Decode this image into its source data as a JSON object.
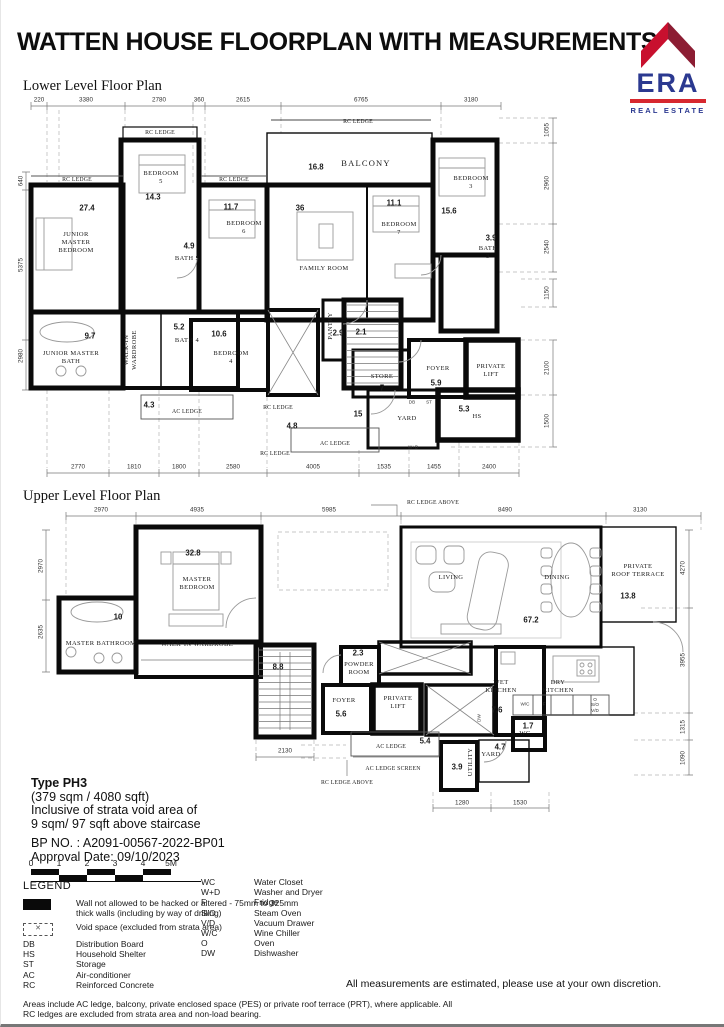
{
  "header": {
    "title": "WATTEN HOUSE FLOORPLAN WITH MEASUREMENTS",
    "logo": {
      "name": "ERA",
      "tagline": "REAL ESTATE",
      "colors": {
        "roof_left": "#C8102E",
        "roof_right": "#8C1D33",
        "text": "#2B3990",
        "bar": "#D7282F"
      }
    }
  },
  "lower_plan": {
    "heading": "Lower Level Floor Plan",
    "labels": [
      {
        "t": "220",
        "x": 38,
        "y": 100,
        "c": "dim"
      },
      {
        "t": "3380",
        "x": 85,
        "y": 100,
        "c": "dim"
      },
      {
        "t": "2780",
        "x": 158,
        "y": 100,
        "c": "dim"
      },
      {
        "t": "360",
        "x": 198,
        "y": 100,
        "c": "dim"
      },
      {
        "t": "2615",
        "x": 242,
        "y": 100,
        "c": "dim"
      },
      {
        "t": "6765",
        "x": 360,
        "y": 100,
        "c": "dim"
      },
      {
        "t": "3180",
        "x": 470,
        "y": 100,
        "c": "dim"
      },
      {
        "t": "2770",
        "x": 77,
        "y": 467,
        "c": "dim"
      },
      {
        "t": "1810",
        "x": 133,
        "y": 467,
        "c": "dim"
      },
      {
        "t": "1800",
        "x": 178,
        "y": 467,
        "c": "dim"
      },
      {
        "t": "2580",
        "x": 232,
        "y": 467,
        "c": "dim"
      },
      {
        "t": "4005",
        "x": 312,
        "y": 467,
        "c": "dim"
      },
      {
        "t": "1535",
        "x": 383,
        "y": 467,
        "c": "dim"
      },
      {
        "t": "1455",
        "x": 433,
        "y": 467,
        "c": "dim"
      },
      {
        "t": "2400",
        "x": 488,
        "y": 467,
        "c": "dim"
      },
      {
        "t": "640",
        "x": 20,
        "y": 181,
        "c": "dim",
        "r": -90
      },
      {
        "t": "5375",
        "x": 20,
        "y": 265,
        "c": "dim",
        "r": -90
      },
      {
        "t": "2980",
        "x": 20,
        "y": 356,
        "c": "dim",
        "r": -90
      },
      {
        "t": "1055",
        "x": 546,
        "y": 130,
        "c": "dim",
        "r": -90
      },
      {
        "t": "2960",
        "x": 546,
        "y": 183,
        "c": "dim",
        "r": -90
      },
      {
        "t": "2540",
        "x": 546,
        "y": 247,
        "c": "dim",
        "r": -90
      },
      {
        "t": "1150",
        "x": 546,
        "y": 293,
        "c": "dim",
        "r": -90
      },
      {
        "t": "2100",
        "x": 546,
        "y": 368,
        "c": "dim",
        "r": -90
      },
      {
        "t": "1500",
        "x": 546,
        "y": 421,
        "c": "dim",
        "r": -90
      },
      {
        "t": "RC LEDGE",
        "x": 76,
        "y": 180,
        "c": "ledge"
      },
      {
        "t": "RC LEDGE",
        "x": 159,
        "y": 133,
        "c": "ledge"
      },
      {
        "t": "RC LEDGE",
        "x": 233,
        "y": 180,
        "c": "ledge"
      },
      {
        "t": "RC LEDGE",
        "x": 357,
        "y": 122,
        "c": "ledge"
      },
      {
        "t": "RC LEDGE",
        "x": 277,
        "y": 408,
        "c": "ledge"
      },
      {
        "t": "RC LEDGE",
        "x": 274,
        "y": 454,
        "c": "ledge"
      },
      {
        "t": "AC LEDGE",
        "x": 186,
        "y": 412,
        "c": "ledge"
      },
      {
        "t": "AC LEDGE",
        "x": 334,
        "y": 444,
        "c": "ledge"
      },
      {
        "t": "27.4",
        "x": 86,
        "y": 208,
        "c": "area"
      },
      {
        "t": "JUNIOR\nMASTER\nBEDROOM",
        "x": 75,
        "y": 243,
        "c": "room"
      },
      {
        "t": "14.3",
        "x": 152,
        "y": 197,
        "c": "area"
      },
      {
        "t": "BEDROOM\n5",
        "x": 160,
        "y": 178,
        "c": "room"
      },
      {
        "t": "4.9",
        "x": 188,
        "y": 246,
        "c": "area"
      },
      {
        "t": "BATH 5",
        "x": 186,
        "y": 259,
        "c": "room"
      },
      {
        "t": "11.7",
        "x": 230,
        "y": 207,
        "c": "area"
      },
      {
        "t": "BEDROOM\n6",
        "x": 243,
        "y": 228,
        "c": "room"
      },
      {
        "t": "36",
        "x": 299,
        "y": 208,
        "c": "area"
      },
      {
        "t": "FAMILY ROOM",
        "x": 323,
        "y": 269,
        "c": "room"
      },
      {
        "t": "16.8",
        "x": 315,
        "y": 167,
        "c": "area"
      },
      {
        "t": "BALCONY",
        "x": 365,
        "y": 163,
        "c": "roomlg"
      },
      {
        "t": "11.1",
        "x": 393,
        "y": 203,
        "c": "area"
      },
      {
        "t": "BEDROOM\n7",
        "x": 398,
        "y": 229,
        "c": "room"
      },
      {
        "t": "15.6",
        "x": 448,
        "y": 211,
        "c": "area"
      },
      {
        "t": "BEDROOM\n3",
        "x": 470,
        "y": 183,
        "c": "room"
      },
      {
        "t": "3.9",
        "x": 490,
        "y": 238,
        "c": "area"
      },
      {
        "t": "BATH\n3",
        "x": 487,
        "y": 253,
        "c": "room"
      },
      {
        "t": "9.7",
        "x": 89,
        "y": 336,
        "c": "area"
      },
      {
        "t": "JUNIOR MASTER\nBATH",
        "x": 70,
        "y": 358,
        "c": "room"
      },
      {
        "t": "WALK-IN\nWARDROBE",
        "x": 130,
        "y": 350,
        "c": "room",
        "r": -90
      },
      {
        "t": "5.2",
        "x": 178,
        "y": 327,
        "c": "area"
      },
      {
        "t": "BATH 4",
        "x": 186,
        "y": 341,
        "c": "room"
      },
      {
        "t": "10.6",
        "x": 218,
        "y": 334,
        "c": "area"
      },
      {
        "t": "BEDROOM\n4",
        "x": 230,
        "y": 358,
        "c": "room"
      },
      {
        "t": "PANTRY",
        "x": 330,
        "y": 326,
        "c": "room",
        "r": -90
      },
      {
        "t": "2.9",
        "x": 337,
        "y": 333,
        "c": "area"
      },
      {
        "t": "2.1",
        "x": 360,
        "y": 332,
        "c": "area"
      },
      {
        "t": "STORE",
        "x": 381,
        "y": 377,
        "c": "room"
      },
      {
        "t": "7",
        "x": 381,
        "y": 388,
        "c": "area"
      },
      {
        "t": "FOYER",
        "x": 437,
        "y": 369,
        "c": "room"
      },
      {
        "t": "5.9",
        "x": 435,
        "y": 383,
        "c": "area"
      },
      {
        "t": "PRIVATE\nLIFT",
        "x": 490,
        "y": 371,
        "c": "room"
      },
      {
        "t": "5.3",
        "x": 463,
        "y": 409,
        "c": "area"
      },
      {
        "t": "HS",
        "x": 476,
        "y": 417,
        "c": "room"
      },
      {
        "t": "15",
        "x": 357,
        "y": 414,
        "c": "area"
      },
      {
        "t": "YARD",
        "x": 406,
        "y": 419,
        "c": "room"
      },
      {
        "t": "4.3",
        "x": 148,
        "y": 405,
        "c": "area"
      },
      {
        "t": "4.8",
        "x": 291,
        "y": 426,
        "c": "area"
      },
      {
        "t": "DB",
        "x": 411,
        "y": 402,
        "c": "tiny"
      },
      {
        "t": "ST",
        "x": 428,
        "y": 402,
        "c": "tiny"
      },
      {
        "t": "W+D",
        "x": 412,
        "y": 447,
        "c": "tiny"
      }
    ]
  },
  "upper_plan": {
    "heading": "Upper Level Floor Plan",
    "labels": [
      {
        "t": "2970",
        "x": 100,
        "y": 510,
        "c": "dim"
      },
      {
        "t": "4935",
        "x": 196,
        "y": 510,
        "c": "dim"
      },
      {
        "t": "5985",
        "x": 328,
        "y": 510,
        "c": "dim"
      },
      {
        "t": "8490",
        "x": 504,
        "y": 510,
        "c": "dim"
      },
      {
        "t": "3130",
        "x": 639,
        "y": 510,
        "c": "dim"
      },
      {
        "t": "2970",
        "x": 40,
        "y": 566,
        "c": "dim",
        "r": -90
      },
      {
        "t": "2635",
        "x": 40,
        "y": 632,
        "c": "dim",
        "r": -90
      },
      {
        "t": "4270",
        "x": 682,
        "y": 568,
        "c": "dim",
        "r": -90
      },
      {
        "t": "3955",
        "x": 682,
        "y": 660,
        "c": "dim",
        "r": -90
      },
      {
        "t": "1315",
        "x": 682,
        "y": 727,
        "c": "dim",
        "r": -90
      },
      {
        "t": "1090",
        "x": 682,
        "y": 758,
        "c": "dim",
        "r": -90
      },
      {
        "t": "2130",
        "x": 284,
        "y": 751,
        "c": "dim"
      },
      {
        "t": "1280",
        "x": 461,
        "y": 803,
        "c": "dim"
      },
      {
        "t": "1530",
        "x": 519,
        "y": 803,
        "c": "dim"
      },
      {
        "t": "RC LEDGE ABOVE",
        "x": 432,
        "y": 503,
        "c": "ledge"
      },
      {
        "t": "AC LEDGE",
        "x": 390,
        "y": 747,
        "c": "ledge"
      },
      {
        "t": "AC LEDGE SCREEN",
        "x": 392,
        "y": 769,
        "c": "ledge"
      },
      {
        "t": "RC LEDGE ABOVE",
        "x": 346,
        "y": 783,
        "c": "ledge"
      },
      {
        "t": "32.8",
        "x": 192,
        "y": 553,
        "c": "area"
      },
      {
        "t": "MASTER\nBEDROOM",
        "x": 196,
        "y": 584,
        "c": "room"
      },
      {
        "t": "10",
        "x": 117,
        "y": 617,
        "c": "area"
      },
      {
        "t": "MASTER BATHROOM",
        "x": 100,
        "y": 644,
        "c": "room"
      },
      {
        "t": "WALK-IN WARDROBE",
        "x": 196,
        "y": 645,
        "c": "room"
      },
      {
        "t": "8.8",
        "x": 277,
        "y": 667,
        "c": "area"
      },
      {
        "t": "2.3",
        "x": 357,
        "y": 653,
        "c": "area"
      },
      {
        "t": "POWDER\nROOM",
        "x": 358,
        "y": 669,
        "c": "room"
      },
      {
        "t": "FOYER",
        "x": 343,
        "y": 701,
        "c": "room"
      },
      {
        "t": "5.6",
        "x": 340,
        "y": 714,
        "c": "area"
      },
      {
        "t": "PRIVATE\nLIFT",
        "x": 397,
        "y": 703,
        "c": "room"
      },
      {
        "t": "LIVING",
        "x": 450,
        "y": 578,
        "c": "room"
      },
      {
        "t": "DINING",
        "x": 556,
        "y": 578,
        "c": "room"
      },
      {
        "t": "67.2",
        "x": 530,
        "y": 620,
        "c": "area"
      },
      {
        "t": "PRIVATE\nROOF TERRACE",
        "x": 637,
        "y": 571,
        "c": "room"
      },
      {
        "t": "13.8",
        "x": 627,
        "y": 596,
        "c": "area"
      },
      {
        "t": "WET\nKITCHEN",
        "x": 500,
        "y": 687,
        "c": "room"
      },
      {
        "t": "7.6",
        "x": 496,
        "y": 710,
        "c": "area"
      },
      {
        "t": "DRY\nKITCHEN",
        "x": 557,
        "y": 687,
        "c": "room"
      },
      {
        "t": "1.7",
        "x": 527,
        "y": 726,
        "c": "area"
      },
      {
        "t": "WC",
        "x": 524,
        "y": 734,
        "c": "room"
      },
      {
        "t": "4.7",
        "x": 499,
        "y": 747,
        "c": "area"
      },
      {
        "t": "YARD",
        "x": 490,
        "y": 755,
        "c": "room"
      },
      {
        "t": "3.9",
        "x": 456,
        "y": 767,
        "c": "area"
      },
      {
        "t": "UTILITY",
        "x": 470,
        "y": 762,
        "c": "room",
        "r": -90
      },
      {
        "t": "5.4",
        "x": 424,
        "y": 741,
        "c": "area"
      },
      {
        "t": "W/C",
        "x": 524,
        "y": 704,
        "c": "tiny"
      },
      {
        "t": "F",
        "x": 543,
        "y": 704,
        "c": "tiny"
      },
      {
        "t": "O\nS/O\nV/D",
        "x": 594,
        "y": 705,
        "c": "tiny"
      },
      {
        "t": "DW",
        "x": 478,
        "y": 718,
        "c": "tiny",
        "r": -90
      }
    ]
  },
  "info": {
    "type_label": "Type PH3",
    "size_line": "(379 sqm / 4080 sqft)",
    "void_line1": "Inclusive of strata void area of",
    "void_line2": "9 sqm/ 97 sqft above staircase",
    "bp_no": "BP NO. : A2091-00567-2022-BP01",
    "approval": "Approval Date: 09/10/2023"
  },
  "scale": {
    "ticks": [
      "0",
      "1",
      "2",
      "3",
      "4",
      "5M"
    ]
  },
  "legend": {
    "title": "LEGEND",
    "wall_item": "Wall not allowed to be hacked or altered - 75mm to 325mm thick walls (including by way of drilling)",
    "void_item": "Void space (excluded from strata area)",
    "abbrev_left": [
      {
        "key": "DB",
        "desc": "Distribution Board"
      },
      {
        "key": "HS",
        "desc": "Household Shelter"
      },
      {
        "key": "ST",
        "desc": "Storage"
      },
      {
        "key": "AC",
        "desc": "Air-conditioner"
      },
      {
        "key": "RC",
        "desc": "Reinforced Concrete"
      }
    ],
    "abbrev_right": [
      {
        "key": "WC",
        "desc": "Water Closet"
      },
      {
        "key": "W+D",
        "desc": "Washer and Dryer"
      },
      {
        "key": "F",
        "desc": "Fridge"
      },
      {
        "key": "S/O",
        "desc": "Steam Oven"
      },
      {
        "key": "V/D",
        "desc": "Vacuum Drawer"
      },
      {
        "key": "W/C",
        "desc": "Wine Chiller"
      },
      {
        "key": "O",
        "desc": "Oven"
      },
      {
        "key": "DW",
        "desc": "Dishwasher"
      }
    ],
    "note": "Areas include AC ledge, balcony, private enclosed space (PES) or private roof terrace (PRT), where applicable. All RC ledges are excluded from strata area and non-load bearing."
  },
  "disclaimer": "All measurements are estimated, please use at your own discretion."
}
